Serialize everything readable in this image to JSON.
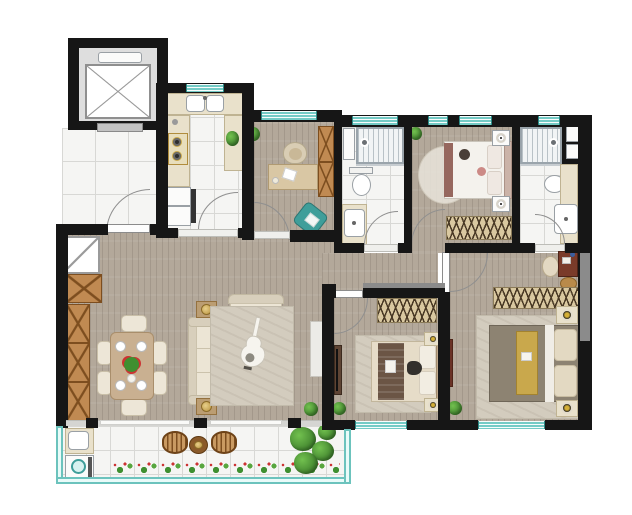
{
  "title": "apartment-floor-plan",
  "canvas": {
    "width": 632,
    "height": 515
  },
  "colors": {
    "bg": "#ffffff",
    "wall": "#161616",
    "wall-gray": "#8b8b8b",
    "wood-floor": "#b3a89a",
    "tile": "#f5f5f3",
    "tile-line": "#d8d8d5",
    "window-teal": "#74cbc6",
    "railing-teal": "#6cc3bd",
    "cabinet-wood": "#c08a52",
    "cabinet-line": "#7d4e1f",
    "counter-beige": "#e9e1cb",
    "wardrobe-beige": "#d9c8a0",
    "wardrobe-stripe": "#4a3a26",
    "sofa-beige": "#ece5d5",
    "rug-beige": "#d3ccbe",
    "bed-white": "#f4f2ed",
    "bed-gray": "#8d8372",
    "bed-gold": "#c9a84c",
    "accent-maroon": "#96675e",
    "chair-teal": "#3f9e9a",
    "vanity-red": "#7a3b2a",
    "plant-green": "#4e9c3e",
    "flower-red": "#cc3333",
    "fixture-white": "#fbfbfa"
  },
  "plan": {
    "type": "residential-floor-plan",
    "rooms": [
      "elevator-lobby",
      "entry-foyer",
      "kitchen",
      "study",
      "hall-bathroom",
      "bedroom-top",
      "ensuite-bathroom",
      "hallway",
      "living-room",
      "dining-area",
      "bedroom-middle",
      "master-bedroom",
      "balcony"
    ],
    "furniture": [
      "elevator",
      "double-kitchen-sink",
      "stove",
      "fridge",
      "desk",
      "desk-chair",
      "teal-lounge-chair",
      "shower",
      "toilet",
      "vanity-sink",
      "double-bed",
      "nightstand",
      "lamp",
      "wardrobe",
      "storage-bench",
      "dining-table",
      "dining-chairs",
      "sofa",
      "loveseat",
      "area-rug",
      "guitar",
      "tv-console",
      "tv-panel",
      "side-table",
      "shoe-cabinet",
      "storage-cabinet",
      "washing-machine",
      "laundry-sink",
      "outdoor-chairs",
      "outdoor-table",
      "flower-planter",
      "potted-plants",
      "vanity-desk"
    ]
  }
}
